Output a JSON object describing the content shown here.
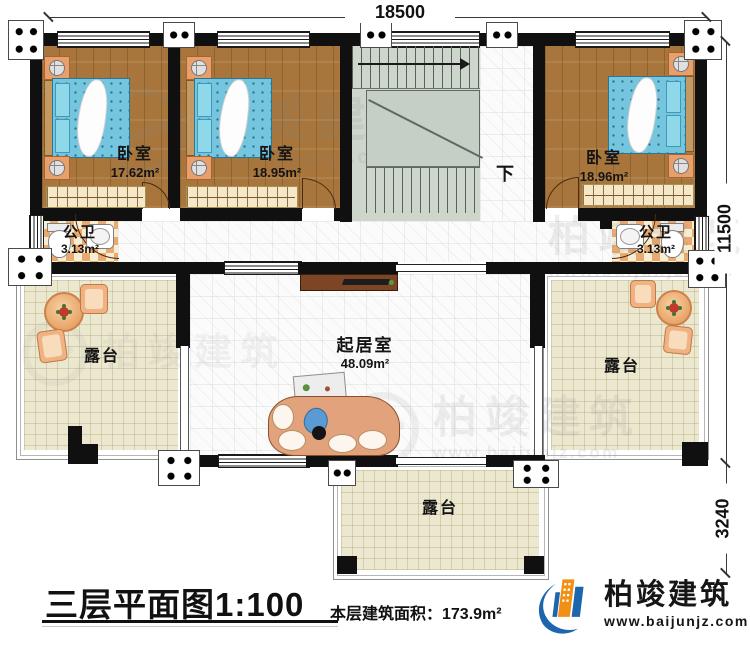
{
  "dimensions": {
    "top": "18500",
    "side_main": "11500",
    "side_lower": "3240"
  },
  "rooms": {
    "bedroom_left": {
      "label": "卧室",
      "area": "17.62m²"
    },
    "bedroom_mid": {
      "label": "卧室",
      "area": "18.95m²"
    },
    "bedroom_right": {
      "label": "卧室",
      "area": "18.96m²"
    },
    "bath_left": {
      "label": "公卫",
      "area": "3.13m²"
    },
    "bath_right": {
      "label": "公卫",
      "area": "3.13m²"
    },
    "living": {
      "label": "起居室",
      "area": "48.09m²"
    },
    "terrace_left": {
      "label": "露台"
    },
    "terrace_right": {
      "label": "露台"
    },
    "terrace_bottom": {
      "label": "露台"
    }
  },
  "stairs": {
    "down": "下"
  },
  "watermark": {
    "name": "柏竣建筑",
    "url": "www.baijunjz.com"
  },
  "footer": {
    "title": "三层平面图1:100",
    "area_note": "本层建筑面积：173.9m²"
  },
  "brand": {
    "name": "柏竣建筑",
    "url": "www.baijunjz.com"
  },
  "colors": {
    "wall": "#101010",
    "wood_floor": "#a8763c",
    "bed_blue": "#74c5dd",
    "terrace": "#ece8d0",
    "stair": "#ced6cb",
    "brand_blue": "#1b66ad",
    "brand_orange": "#f19015"
  }
}
